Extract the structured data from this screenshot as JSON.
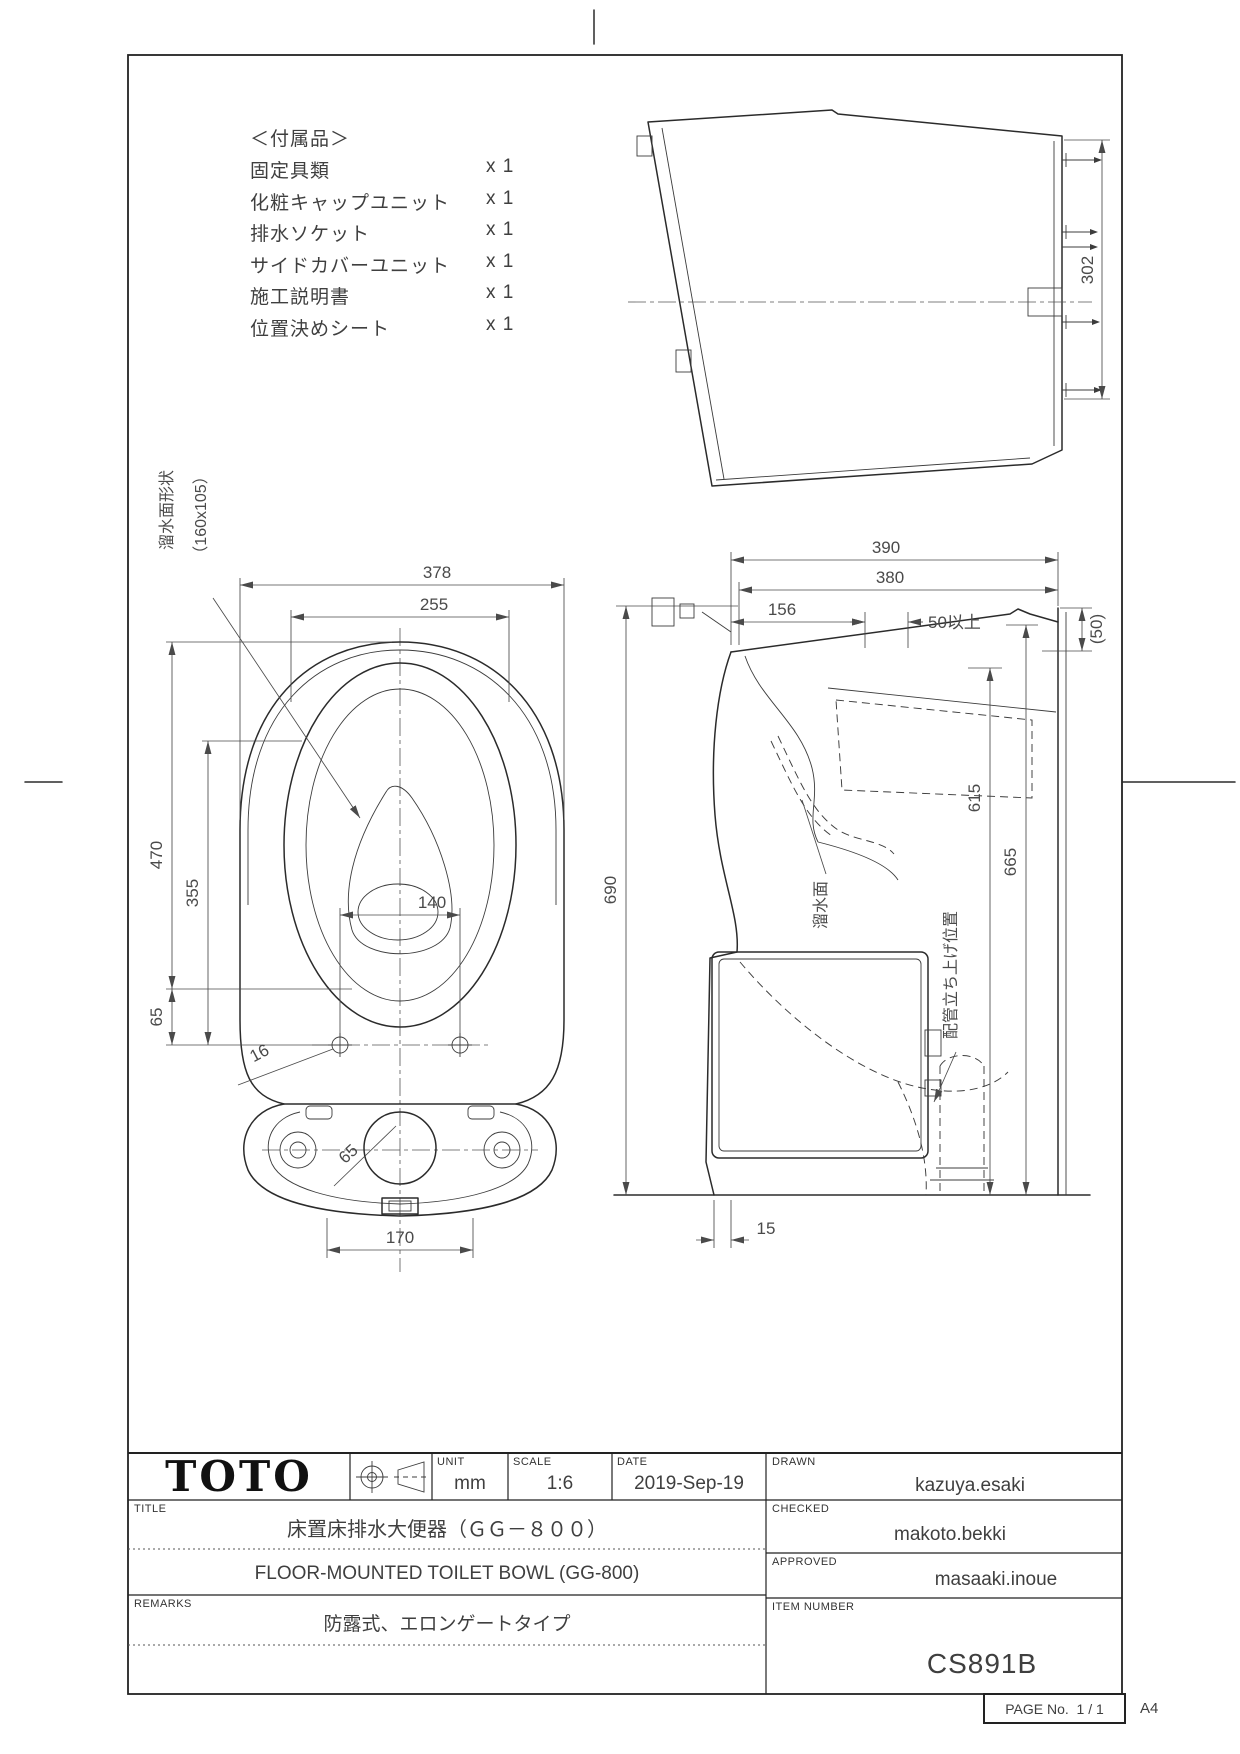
{
  "accessories": {
    "header": "＜付属品＞",
    "items": [
      {
        "name": "固定具類",
        "qty": "x 1"
      },
      {
        "name": "化粧キャップユニット",
        "qty": "x 1"
      },
      {
        "name": "排水ソケット",
        "qty": "x 1"
      },
      {
        "name": "サイドカバーユニット",
        "qty": "x 1"
      },
      {
        "name": "施工説明書",
        "qty": "x 1"
      },
      {
        "name": "位置決めシート",
        "qty": "x 1"
      }
    ]
  },
  "rear_view": {
    "dim_302": "302"
  },
  "plan_view": {
    "note_line1": "溜水面形状",
    "note_line2": "（160x105）",
    "dim_378": "378",
    "dim_255": "255",
    "dim_470": "470",
    "dim_355": "355",
    "dim_65_left": "65",
    "dim_140": "140",
    "dim_16": "16",
    "dim_65_base": "65",
    "dim_170": "170"
  },
  "side_view": {
    "dim_390": "390",
    "dim_380": "380",
    "dim_156": "156",
    "dim_50_min": "50以上",
    "dim_50_ref": "(50)",
    "dim_690": "690",
    "dim_615": "615",
    "dim_665": "665",
    "dim_15": "15",
    "label_water_surface": "溜水面",
    "label_pipe_riser": "配管立ち上げ位置"
  },
  "title_block": {
    "logo": "TOTO",
    "unit_label": "UNIT",
    "unit_value": "mm",
    "scale_label": "SCALE",
    "scale_value": "1:6",
    "date_label": "DATE",
    "date_value": "2019-Sep-19",
    "drawn_label": "DRAWN",
    "drawn_value": "kazuya.esaki",
    "checked_label": "CHECKED",
    "checked_value": "makoto.bekki",
    "approved_label": "APPROVED",
    "approved_value": "masaaki.inoue",
    "title_label": "TITLE",
    "title_jp": "床置床排水大便器（ＧＧ－８００）",
    "title_en": "FLOOR-MOUNTED TOILET BOWL (GG-800)",
    "remarks_label": "REMARKS",
    "remarks_value": "防露式、エロンゲートタイプ",
    "item_number_label": "ITEM NUMBER",
    "item_number_value": "CS891B"
  },
  "footer": {
    "page_label": "PAGE No.",
    "page_value": "1 / 1",
    "paper_size": "A4"
  }
}
